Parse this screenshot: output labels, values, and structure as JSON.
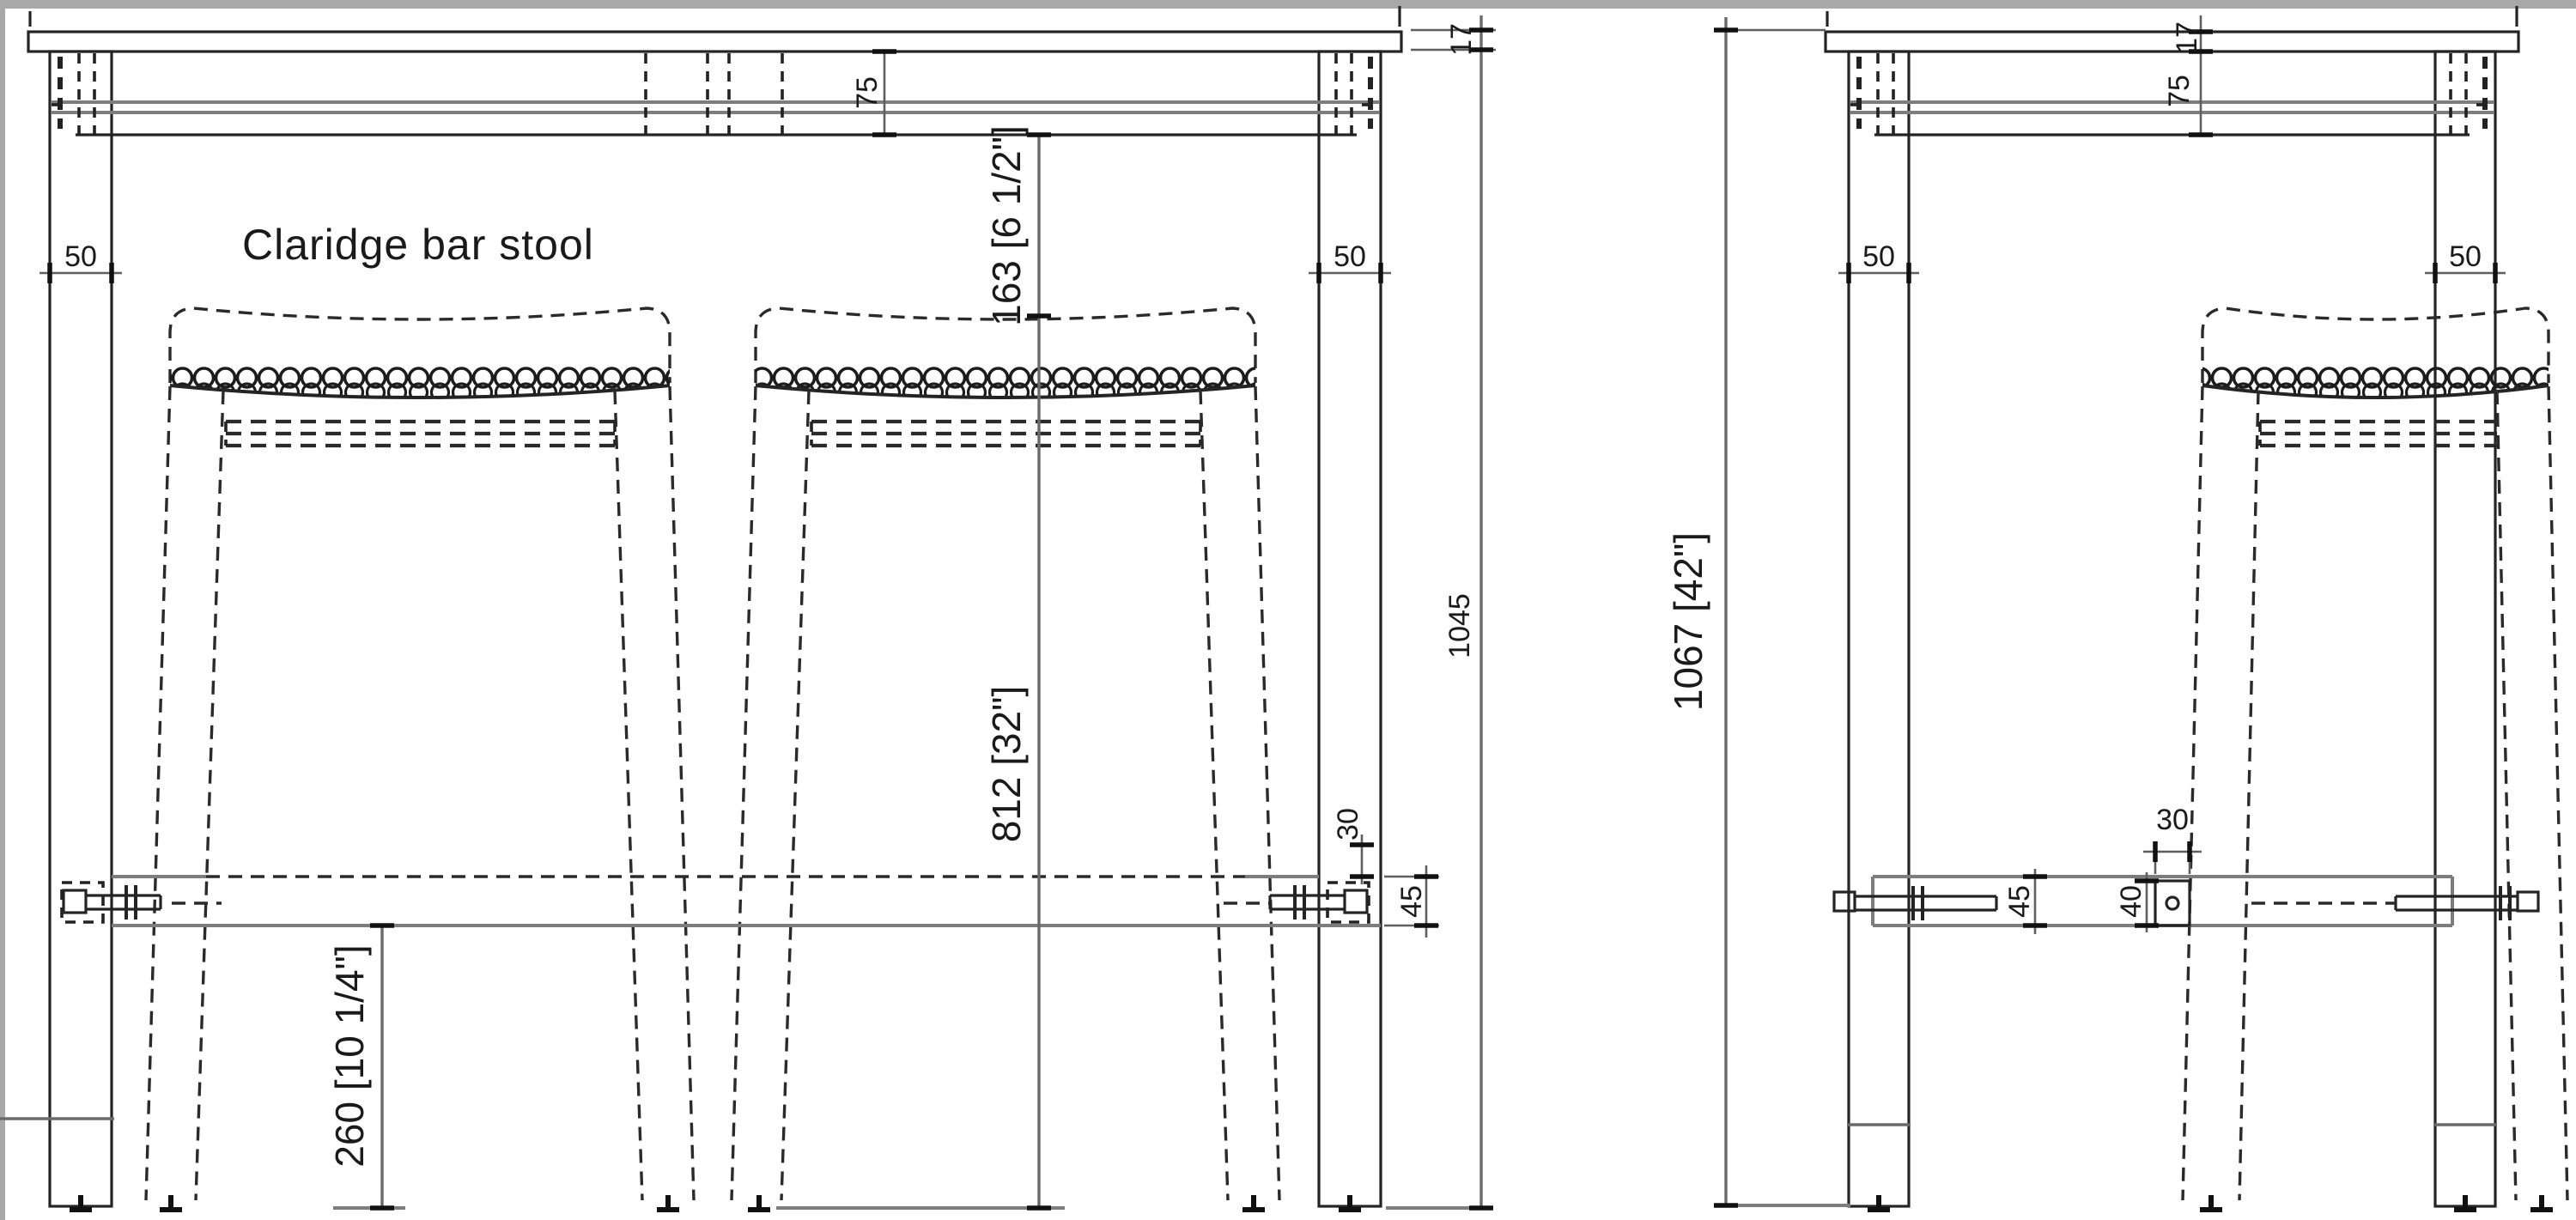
{
  "title": "Claridge bar stool",
  "chrome": {
    "top_bar_color": "#a8a8a8",
    "left_bar_color": "#a8a8a8"
  },
  "front_view": {
    "labels": {
      "leg_width_left": "50",
      "leg_width_right": "50",
      "apron_height": "75",
      "top_thickness": "17",
      "under_top_height": "1045",
      "apron_to_seat": "163 [6 1/2\"]",
      "seat_height": "812 [32\"]",
      "stretcher_floor_clearance": "260 [10 1/4\"]",
      "tenon_width": "30",
      "stretcher_height": "45"
    }
  },
  "side_view": {
    "labels": {
      "top_thickness": "17",
      "apron_height": "75",
      "leg_width_left": "50",
      "leg_width_right": "50",
      "overall_height": "1067 [42\"]",
      "stretcher_height": "45",
      "cross_rail_height": "40",
      "cross_rail_width": "30"
    }
  }
}
